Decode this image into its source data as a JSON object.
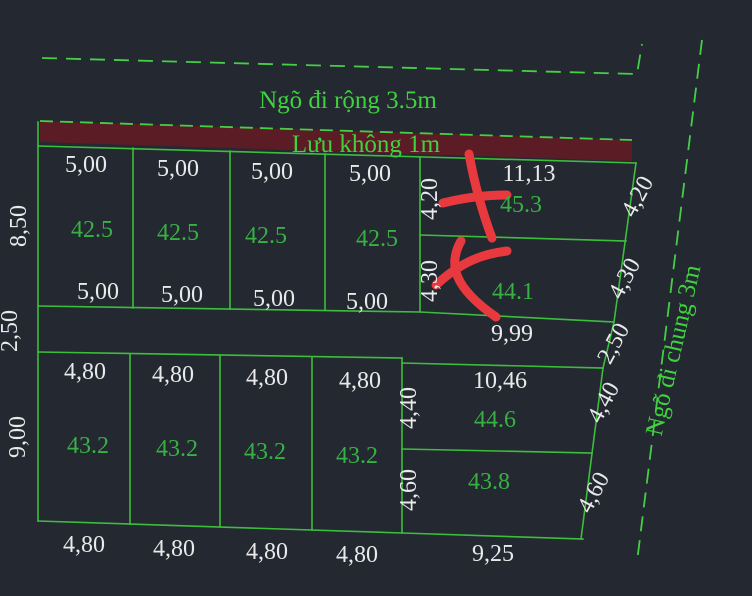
{
  "drawing": {
    "alley_top_label": "Ngõ đi rộng 3.5m",
    "buffer_strip_label": "Lưu không 1m",
    "alley_right_label": "Ngõ đi chung 3m"
  },
  "top_block": {
    "left_height_dim": "8,50",
    "plots": [
      {
        "top_dim": "5,00",
        "area": "42.5",
        "bottom_dim": "5,00"
      },
      {
        "top_dim": "5,00",
        "area": "42.5",
        "bottom_dim": "5,00"
      },
      {
        "top_dim": "5,00",
        "area": "42.5",
        "bottom_dim": "5,00"
      },
      {
        "top_dim": "5,00",
        "area": "42.5",
        "bottom_dim": "5,00"
      },
      {
        "top_dim": "11,13",
        "area": "45.3",
        "left_dim": "4,20",
        "right_dim": "4,20",
        "crossed_out": true
      },
      {
        "area": "44.1",
        "left_dim": "4,30",
        "right_dim": "4,30",
        "crossed_out": true
      }
    ]
  },
  "middle_road": {
    "left_width_dim": "2,50",
    "right_width_dim": "2,50",
    "length_dim": "9,99"
  },
  "bottom_block": {
    "left_height_dim": "9,00",
    "plots": [
      {
        "top_dim": "4,80",
        "area": "43.2",
        "bottom_dim": "4,80"
      },
      {
        "top_dim": "4,80",
        "area": "43.2",
        "bottom_dim": "4,80"
      },
      {
        "top_dim": "4,80",
        "area": "43.2",
        "bottom_dim": "4,80"
      },
      {
        "top_dim": "4,80",
        "area": "43.2",
        "bottom_dim": "4,80"
      },
      {
        "top_dim": "10,46",
        "area": "44.6",
        "left_dim": "4,40",
        "right_dim": "4,40"
      },
      {
        "area": "43.8",
        "left_dim": "4,60",
        "right_dim": "4,60",
        "bottom_dim": "9,25"
      }
    ]
  },
  "colors": {
    "background": "#232831",
    "line_green": "#3cbe3c",
    "dashed_green": "#46cf46",
    "dim_text": "#e9e9e9",
    "area_text": "#37b143",
    "label_text": "#3ed33e",
    "red_mark": "#e8393f",
    "strip_fill": "#5c1c26"
  }
}
